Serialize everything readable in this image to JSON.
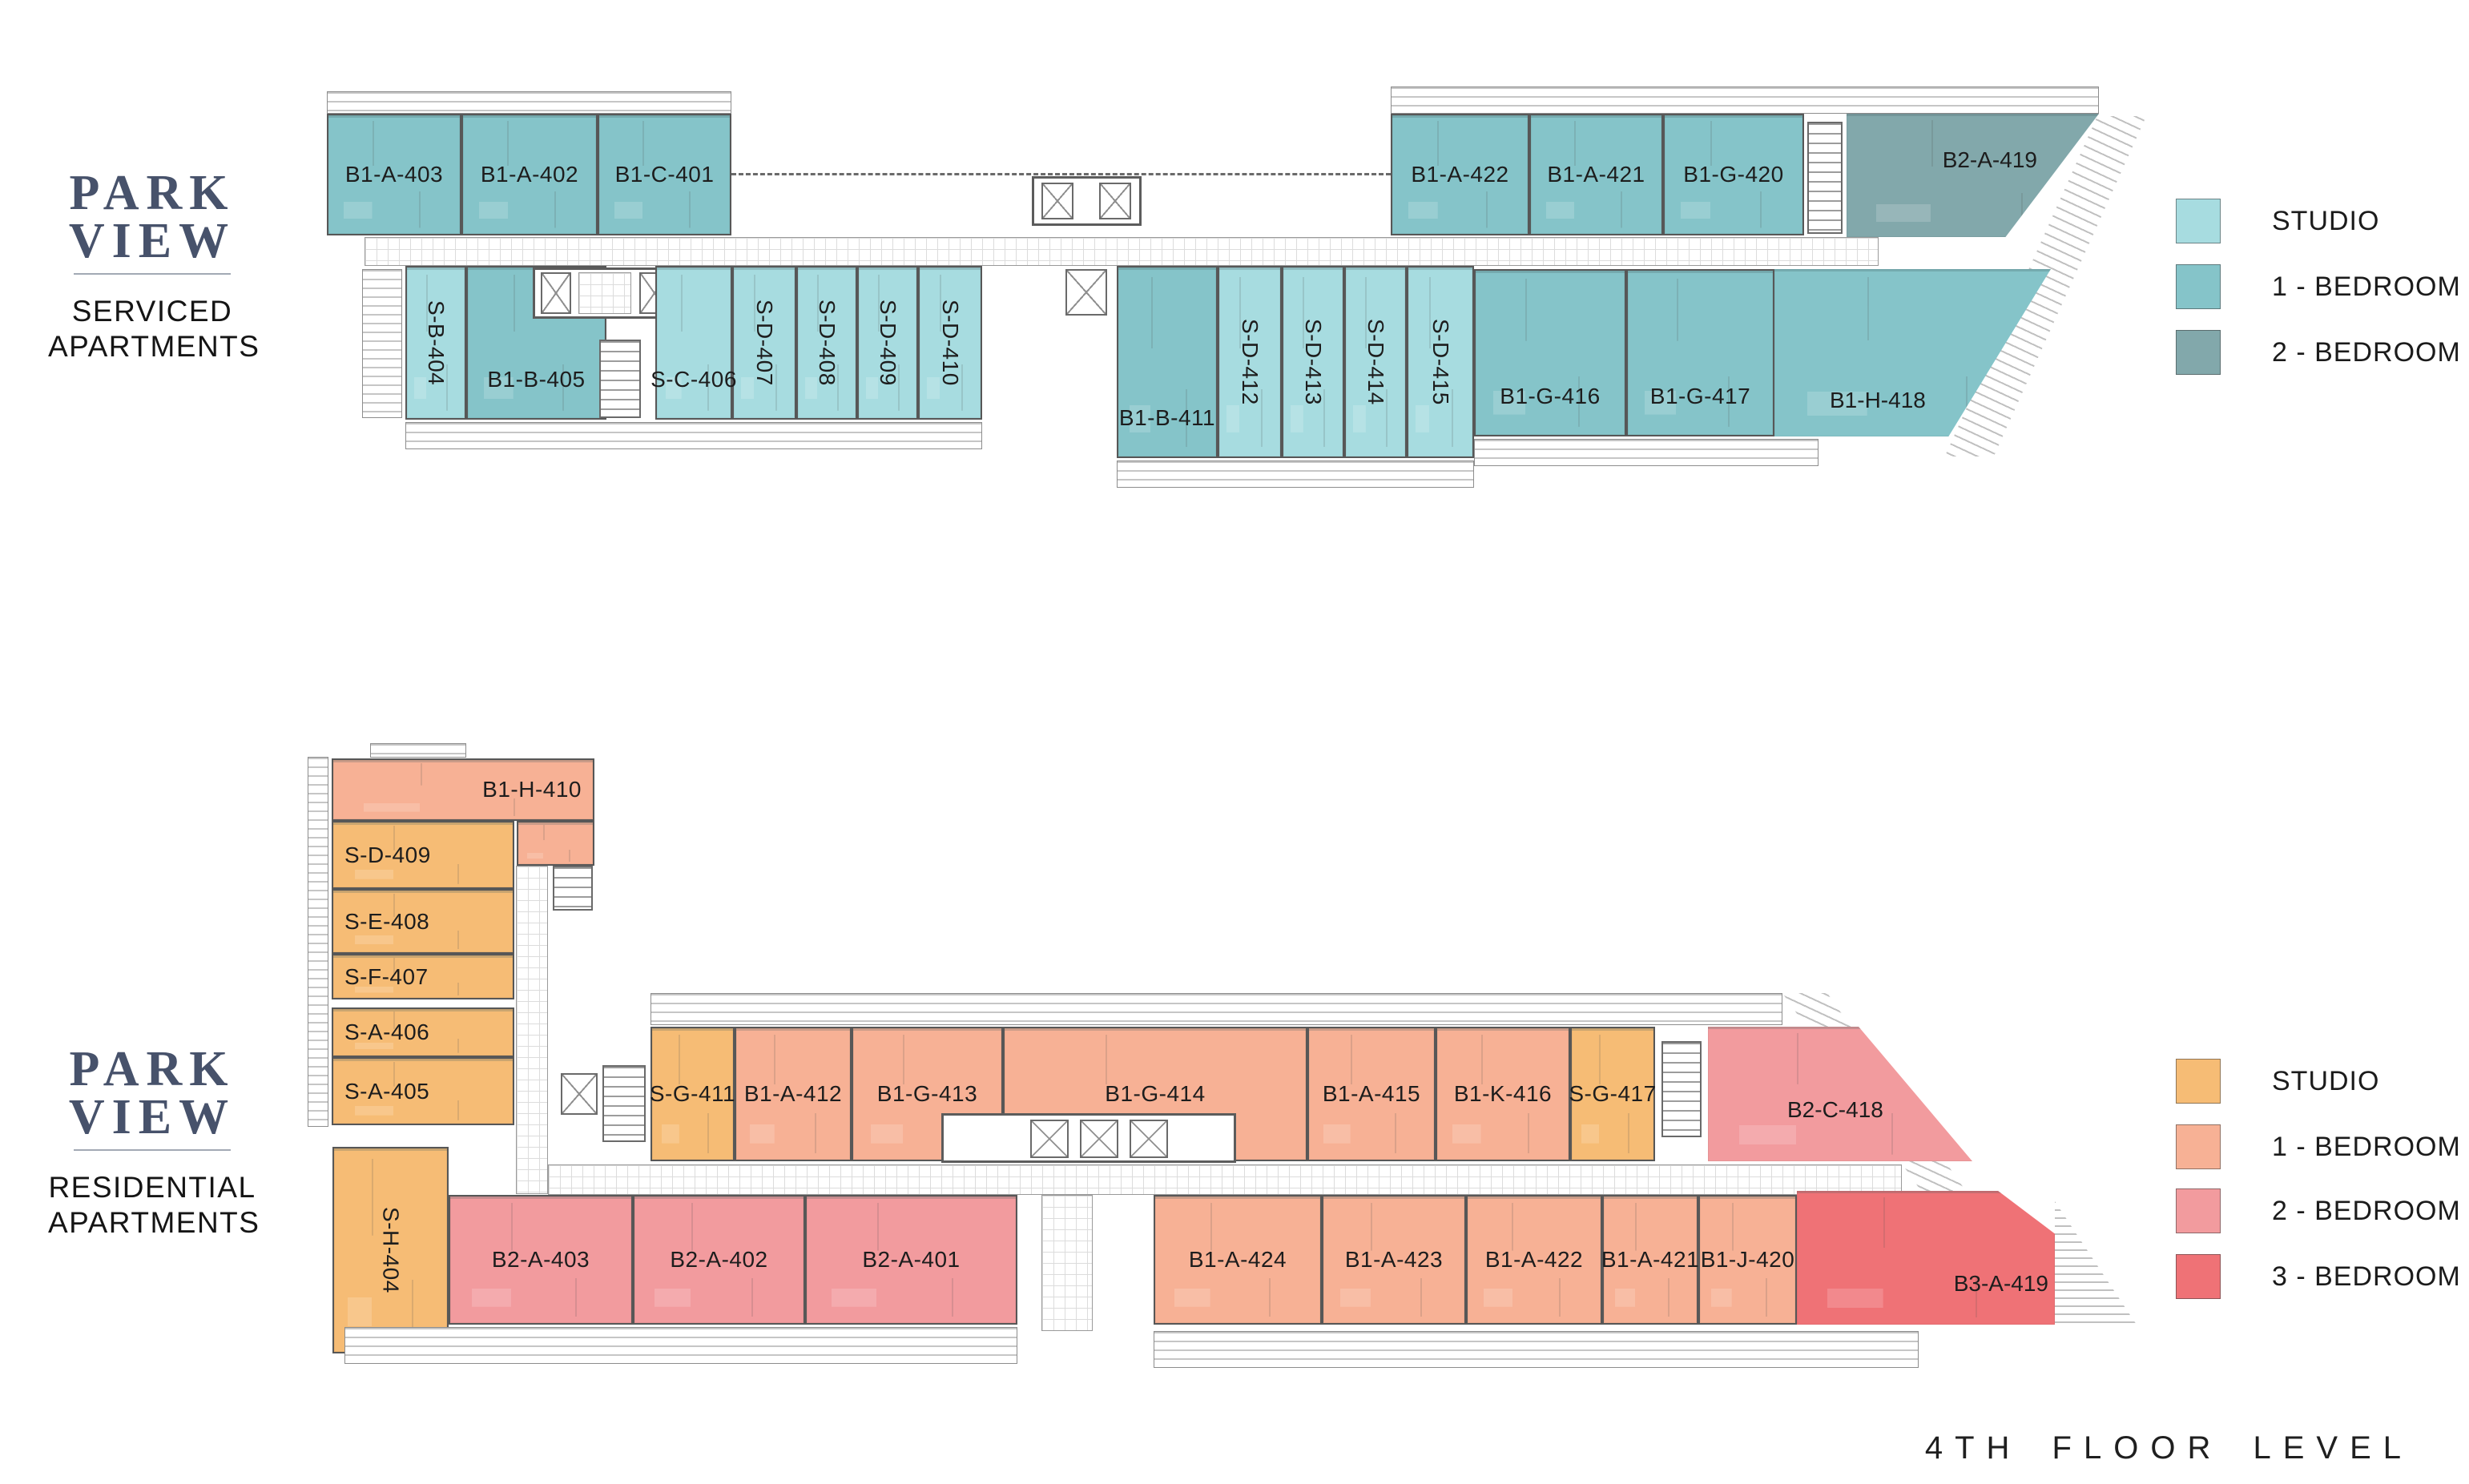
{
  "sheet": {
    "floor_label": "4TH FLOOR LEVEL"
  },
  "branding": {
    "logo_line1": "PARK",
    "logo_line2": "VIEW"
  },
  "serviced": {
    "section_title_line1": "SERVICED",
    "section_title_line2": "APARTMENTS",
    "legend": [
      {
        "label": "STUDIO",
        "color": "#a7dce0"
      },
      {
        "label": "1 - BEDROOM",
        "color": "#85c4c9"
      },
      {
        "label": "2 - BEDROOM",
        "color": "#82a8ab"
      }
    ],
    "units": [
      {
        "label": "B1-A-403",
        "type": "1-bedroom"
      },
      {
        "label": "B1-A-402",
        "type": "1-bedroom"
      },
      {
        "label": "B1-C-401",
        "type": "1-bedroom"
      },
      {
        "label": "B1-A-422",
        "type": "1-bedroom"
      },
      {
        "label": "B1-A-421",
        "type": "1-bedroom"
      },
      {
        "label": "B1-G-420",
        "type": "1-bedroom"
      },
      {
        "label": "B2-A-419",
        "type": "2-bedroom"
      },
      {
        "label": "S-B-404",
        "type": "studio"
      },
      {
        "label": "B1-B-405",
        "type": "1-bedroom"
      },
      {
        "label": "S-C-406",
        "type": "studio"
      },
      {
        "label": "S-D-407",
        "type": "studio"
      },
      {
        "label": "S-D-408",
        "type": "studio"
      },
      {
        "label": "S-D-409",
        "type": "studio"
      },
      {
        "label": "S-D-410",
        "type": "studio"
      },
      {
        "label": "B1-B-411",
        "type": "1-bedroom"
      },
      {
        "label": "S-D-412",
        "type": "studio"
      },
      {
        "label": "S-D-413",
        "type": "studio"
      },
      {
        "label": "S-D-414",
        "type": "studio"
      },
      {
        "label": "S-D-415",
        "type": "studio"
      },
      {
        "label": "B1-G-416",
        "type": "1-bedroom"
      },
      {
        "label": "B1-G-417",
        "type": "1-bedroom"
      },
      {
        "label": "B1-H-418",
        "type": "1-bedroom"
      }
    ]
  },
  "residential": {
    "section_title_line1": "RESIDENTIAL",
    "section_title_line2": "APARTMENTS",
    "legend": [
      {
        "label": "STUDIO",
        "color": "#f6bc75"
      },
      {
        "label": "1 - BEDROOM",
        "color": "#f7b195"
      },
      {
        "label": "2 - BEDROOM",
        "color": "#f29b9e"
      },
      {
        "label": "3 - BEDROOM",
        "color": "#ef7276"
      }
    ],
    "units": [
      {
        "label": "B1-H-410",
        "type": "1-bedroom"
      },
      {
        "label": "S-D-409",
        "type": "studio"
      },
      {
        "label": "S-E-408",
        "type": "studio"
      },
      {
        "label": "S-F-407",
        "type": "studio"
      },
      {
        "label": "S-A-406",
        "type": "studio"
      },
      {
        "label": "S-A-405",
        "type": "studio"
      },
      {
        "label": "S-H-404",
        "type": "studio"
      },
      {
        "label": "S-G-411",
        "type": "studio"
      },
      {
        "label": "B1-A-412",
        "type": "1-bedroom"
      },
      {
        "label": "B1-G-413",
        "type": "1-bedroom"
      },
      {
        "label": "B1-G-414",
        "type": "1-bedroom"
      },
      {
        "label": "B1-A-415",
        "type": "1-bedroom"
      },
      {
        "label": "B1-K-416",
        "type": "1-bedroom"
      },
      {
        "label": "S-G-417",
        "type": "studio"
      },
      {
        "label": "B2-C-418",
        "type": "2-bedroom"
      },
      {
        "label": "B2-A-403",
        "type": "2-bedroom"
      },
      {
        "label": "B2-A-402",
        "type": "2-bedroom"
      },
      {
        "label": "B2-A-401",
        "type": "2-bedroom"
      },
      {
        "label": "B1-A-424",
        "type": "1-bedroom"
      },
      {
        "label": "B1-A-423",
        "type": "1-bedroom"
      },
      {
        "label": "B1-A-422",
        "type": "1-bedroom"
      },
      {
        "label": "B1-A-421",
        "type": "1-bedroom"
      },
      {
        "label": "B1-J-420",
        "type": "1-bedroom"
      },
      {
        "label": "B3-A-419",
        "type": "3-bedroom"
      }
    ]
  }
}
